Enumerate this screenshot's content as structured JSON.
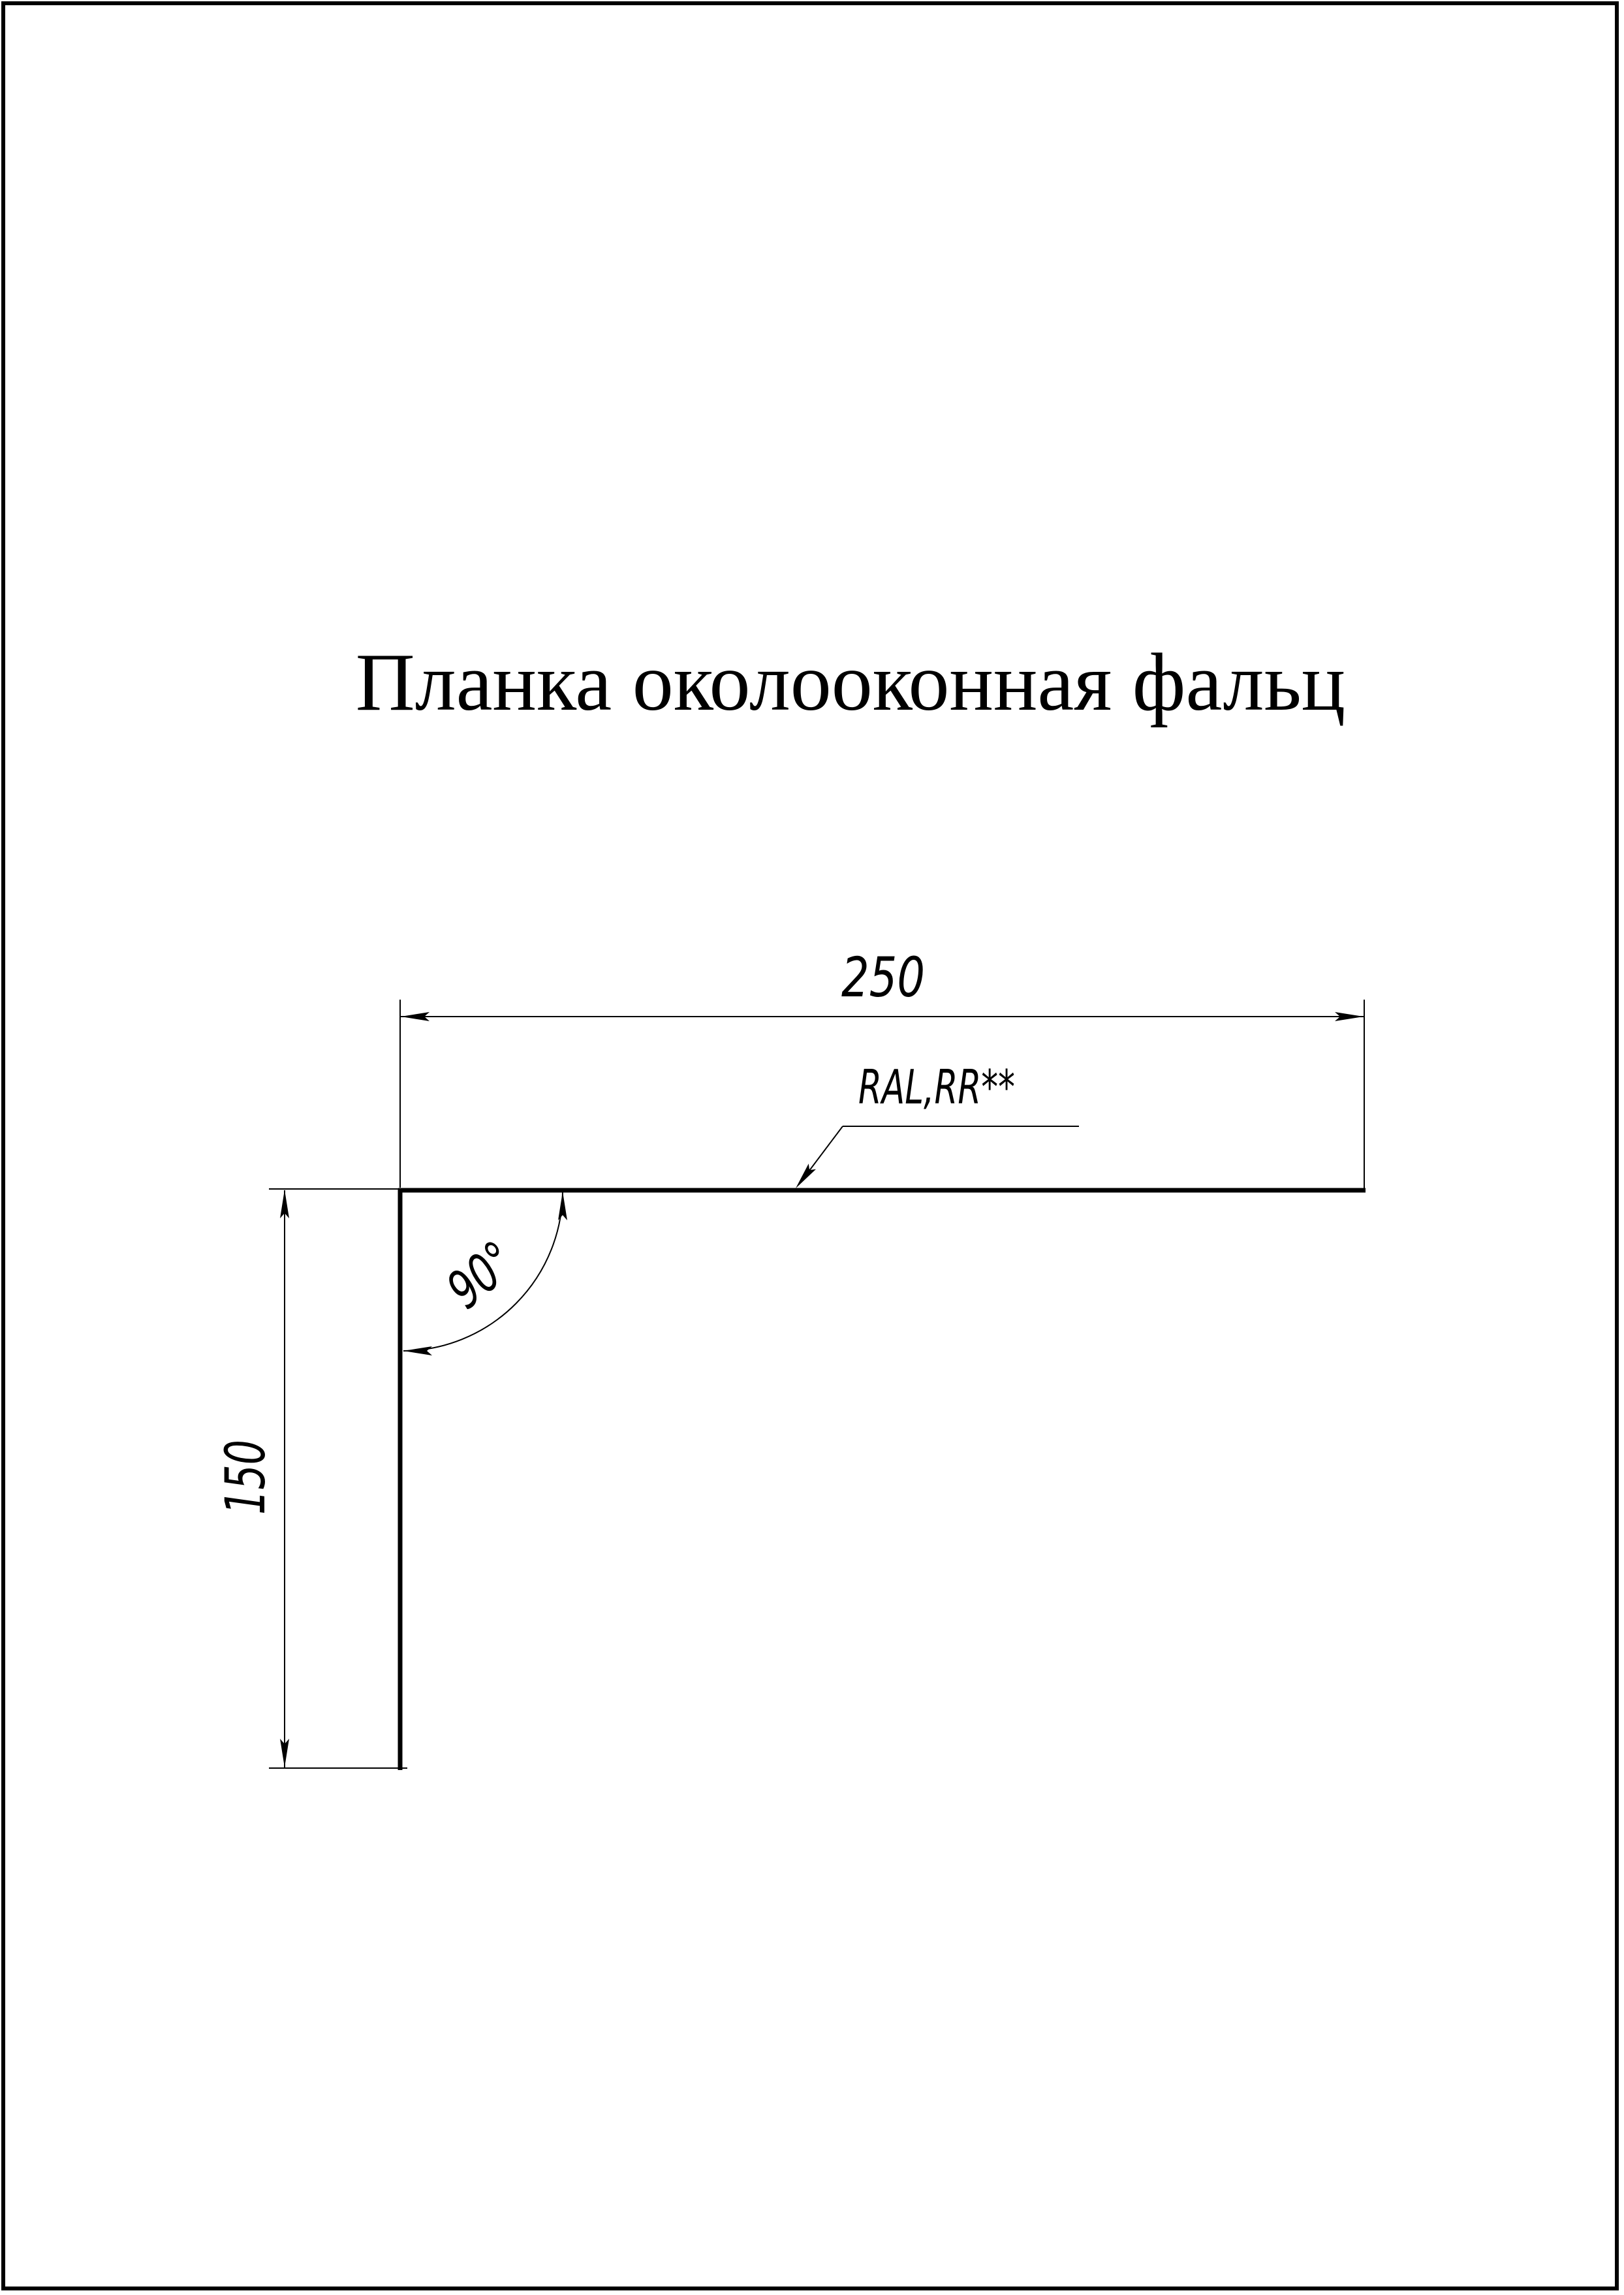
{
  "sheet": {
    "title": "Планка околооконная фальц"
  },
  "dimensions": {
    "width_mm": "250",
    "height_mm": "150",
    "angle": "90°"
  },
  "annotations": {
    "coating_note": "RAL,RR**"
  },
  "colors": {
    "ink": "#000000",
    "paper": "#ffffff"
  }
}
